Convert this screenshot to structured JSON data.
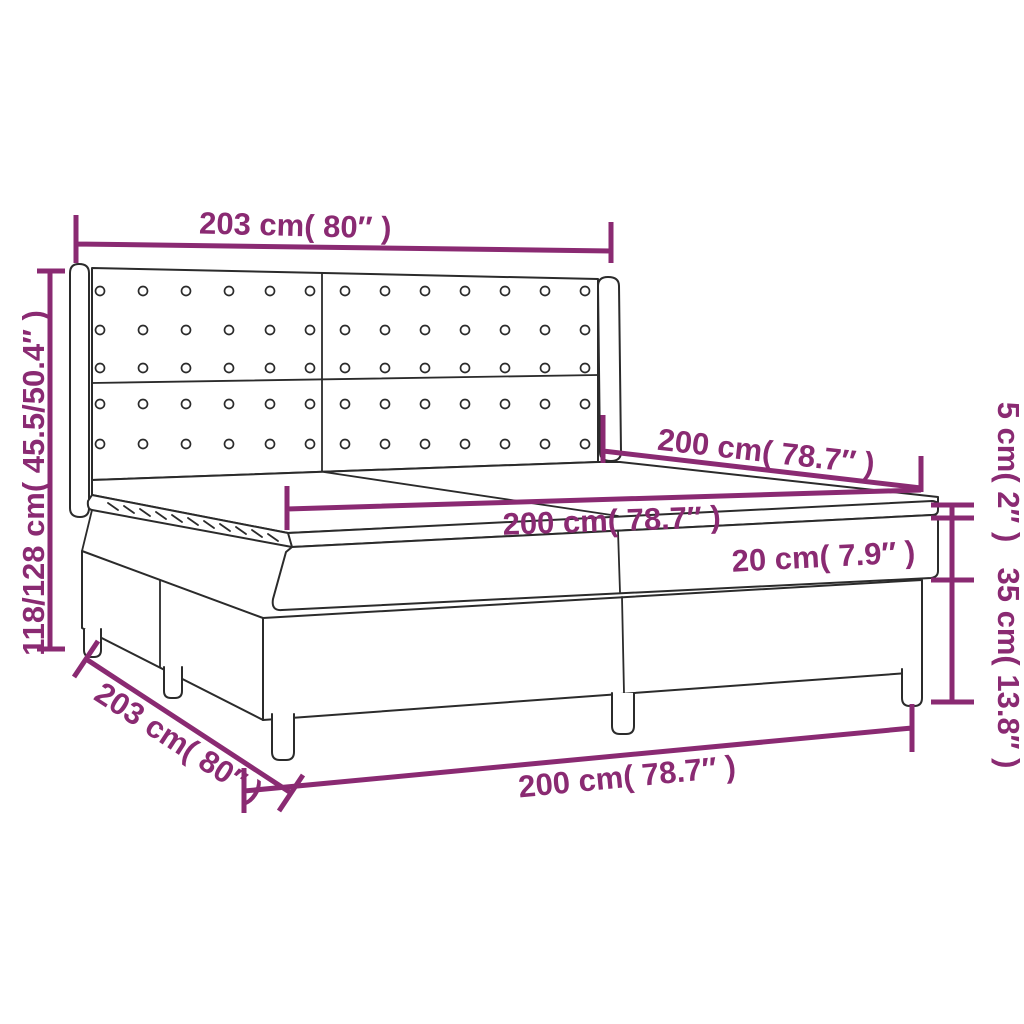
{
  "figure": {
    "kind": "product-dimension-diagram",
    "subject": "box spring bed with winged tufted headboard, two-piece base, mattress and topper",
    "background_color": "#ffffff",
    "line_color": "#2b2b2b",
    "accent_color": "#8a2a72"
  },
  "labels": {
    "headboard_width_top": "203 cm( 80″ )",
    "total_height_left": "118/128 cm( 45.5/50.4″ )",
    "length_upper": "200 cm( 78.7″ )",
    "length_middle": "200 cm( 78.7″ )",
    "mattress_thickness": "20 cm( 7.9″ )",
    "topper_height_right": "5 cm( 2″ )",
    "base_height_right": "35 cm( 13.8″ )",
    "length_bottom": "200 cm( 78.7″ )",
    "base_width_bottom_left": "203 cm( 80″ )"
  }
}
